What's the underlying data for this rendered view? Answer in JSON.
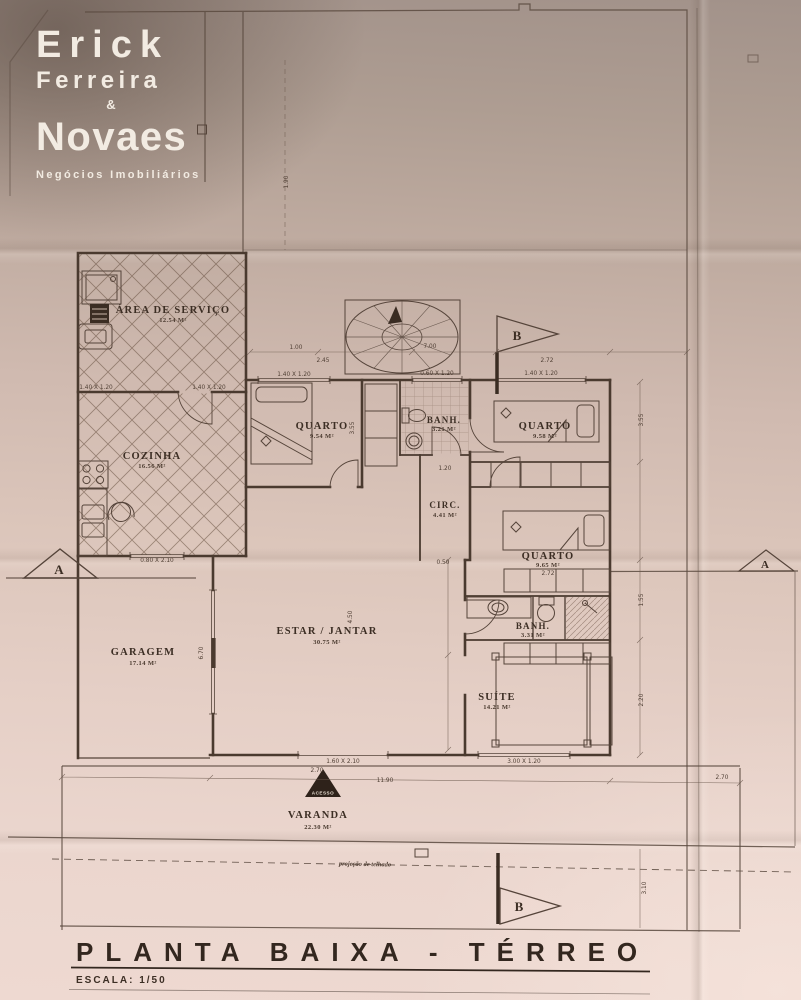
{
  "logo": {
    "line1": "Erick",
    "line2": "Ferreira",
    "ampersand": "&",
    "line3": "Novaes",
    "tagline": "Negócios Imobiliários"
  },
  "plan": {
    "rooms": [
      {
        "name": "ÁREA DE SERVIÇO",
        "area": "12.54 M²"
      },
      {
        "name": "COZINHA",
        "area": "16.56 M²"
      },
      {
        "name": "QUARTO",
        "area": "9.54 M²"
      },
      {
        "name": "BANH.",
        "area": "3.21 M²"
      },
      {
        "name": "QUARTO",
        "area": "9.58 M²"
      },
      {
        "name": "CIRC.",
        "area": "4.41 M²"
      },
      {
        "name": "QUARTO",
        "area": "9.65 M²"
      },
      {
        "name": "GARAGEM",
        "area": "17.14 M²"
      },
      {
        "name": "ESTAR / JANTAR",
        "area": "30.75 M²"
      },
      {
        "name": "BANH.",
        "area": "3.31 M²"
      },
      {
        "name": "SUÍTE",
        "area": "14.21 M²"
      },
      {
        "name": "VARANDA",
        "area": "22.30 M²"
      }
    ],
    "markers": {
      "a": "A",
      "b": "B"
    },
    "annotations": {
      "access": "ACESSO",
      "roof_projection": "projeção de telhado"
    },
    "dimensions": [
      "1.00",
      "7.00",
      "2.45",
      "2.72",
      "1.40 X 1.20",
      "1.40 X 1.20",
      "1.40 X 1.20",
      "0.60 X 1.20",
      "1.40 X 1.20",
      "3.55",
      "3.55",
      "1.20",
      "0.50",
      "1.55",
      "2.20",
      "6.70",
      "4.50",
      "0.80 X 2.10",
      "1.60 X 2.10",
      "3.00 X 1.20",
      "2.70",
      "11.90",
      "2.70",
      "1.90",
      "3.10",
      "2.72"
    ]
  },
  "title_block": {
    "title": "PLANTA BAIXA - TÉRREO",
    "scale": "ESCALA: 1/50"
  }
}
